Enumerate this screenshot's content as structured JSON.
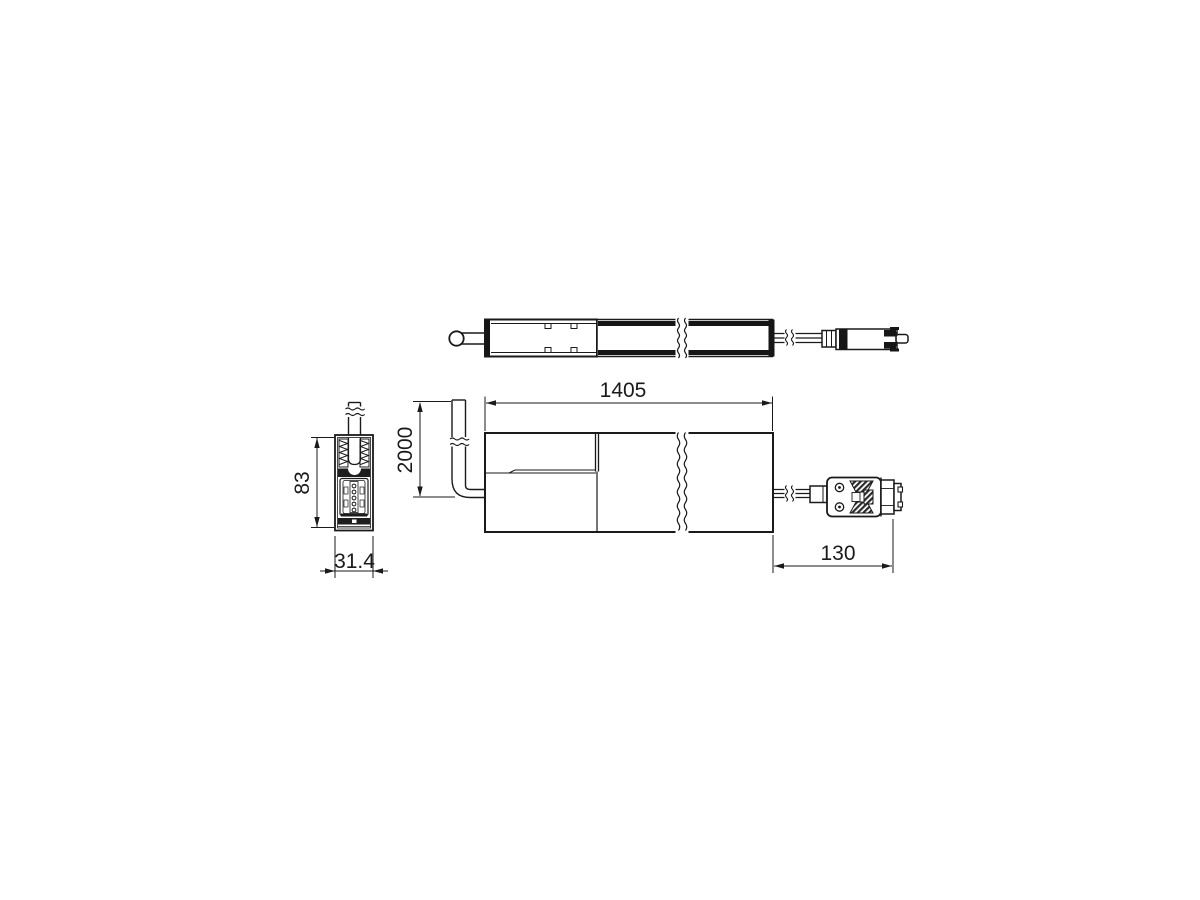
{
  "drawing": {
    "type": "technical-dimension-drawing",
    "views": {
      "top": "top-view",
      "side": "side-view",
      "end": "end-view"
    },
    "dimensions": {
      "length": "1405",
      "cable_length": "2000",
      "connector_length": "130",
      "profile_height": "83",
      "profile_width": "31.4"
    },
    "colors": {
      "line": "#1a1a1a",
      "fill_dark": "#161616",
      "background": "#ffffff"
    }
  }
}
